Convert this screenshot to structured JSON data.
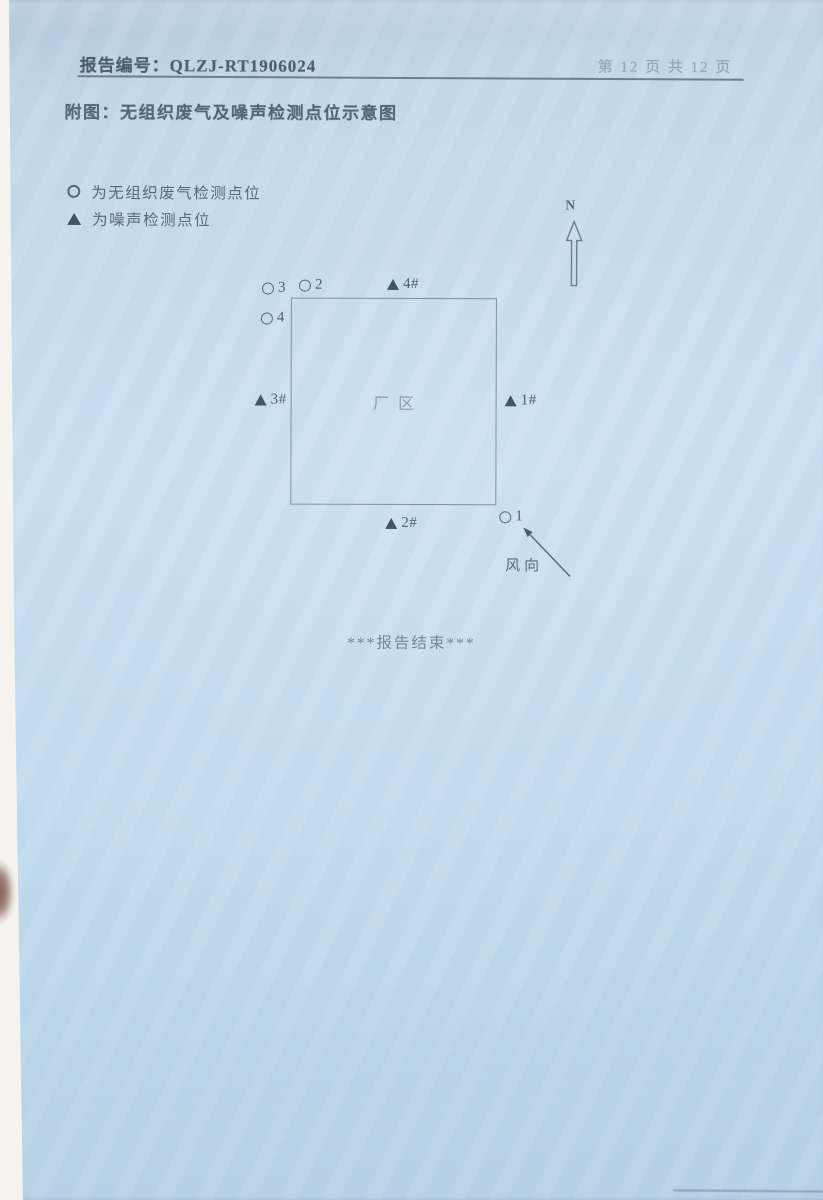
{
  "header": {
    "report_no_label": "报告编号：",
    "report_no": "QLZJ-RT1906024",
    "page_info": "第 12 页  共 12 页"
  },
  "title": "附图：无组织废气及噪声检测点位示意图",
  "legend": {
    "items": [
      {
        "symbol": "circle",
        "label": "为无组织废气检测点位"
      },
      {
        "symbol": "triangle",
        "label": "为噪声检测点位"
      }
    ]
  },
  "compass": {
    "label": "N"
  },
  "diagram": {
    "area_label": "厂区",
    "wind_label": "风向",
    "points": [
      {
        "id": "gas-3",
        "type": "gas",
        "label": "3"
      },
      {
        "id": "gas-2",
        "type": "gas",
        "label": "2"
      },
      {
        "id": "noise-4",
        "type": "noise",
        "label": "4#"
      },
      {
        "id": "gas-4",
        "type": "gas",
        "label": "4"
      },
      {
        "id": "noise-3",
        "type": "noise",
        "label": "3#"
      },
      {
        "id": "noise-1",
        "type": "noise",
        "label": "1#"
      },
      {
        "id": "noise-2",
        "type": "noise",
        "label": "2#"
      },
      {
        "id": "gas-1",
        "type": "gas",
        "label": "1"
      }
    ]
  },
  "footer": {
    "end_note": "***报告结束***"
  },
  "colors": {
    "paper": "#c5dcee",
    "ink": "#53647a",
    "symbol_fill": "#42546a",
    "faint_ink": "#8a9cae"
  }
}
